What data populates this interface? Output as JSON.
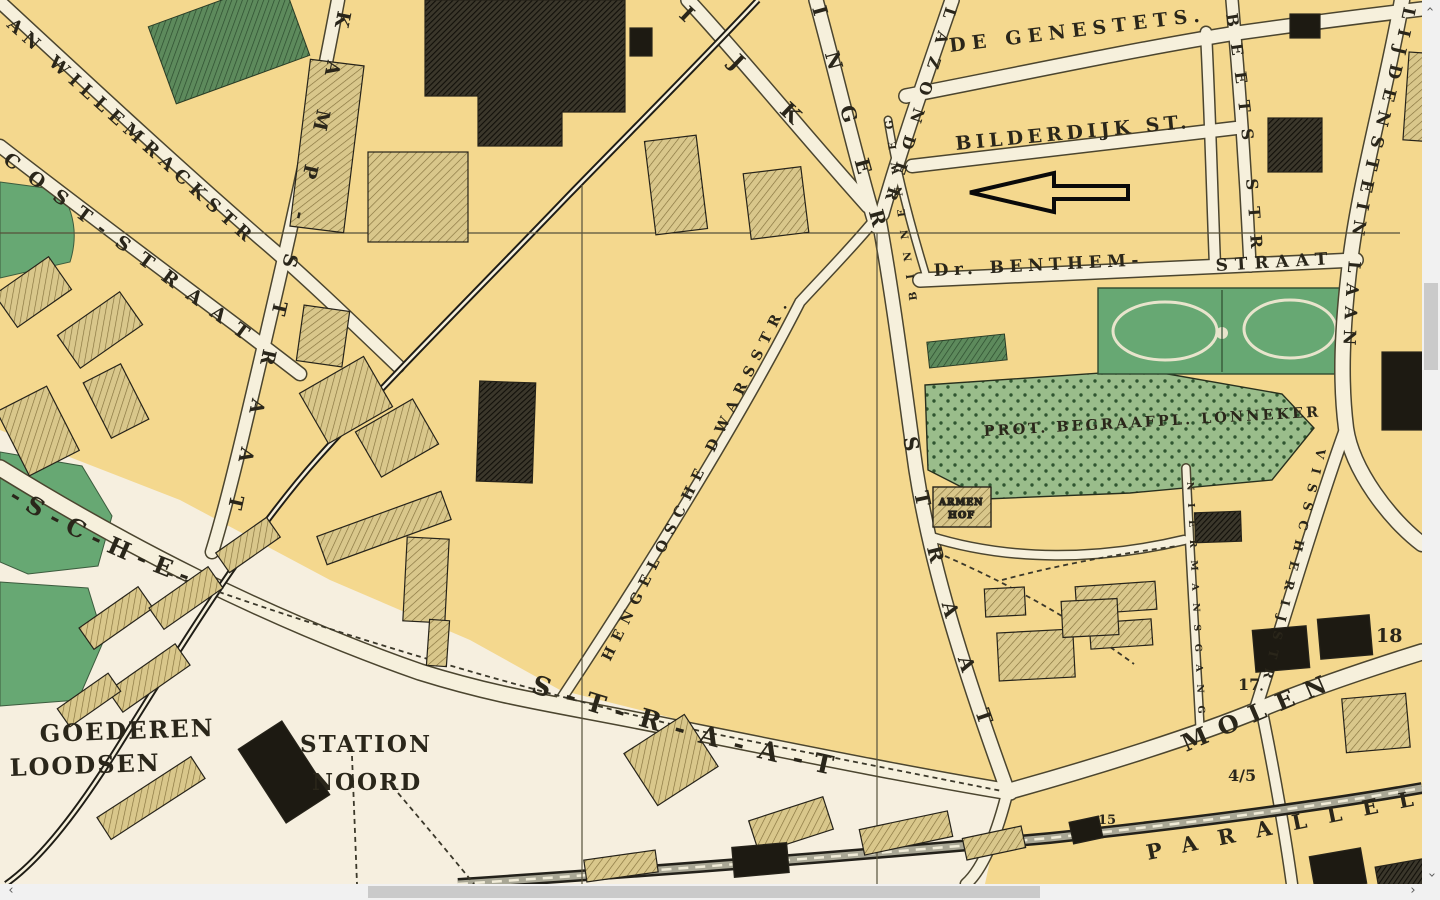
{
  "map": {
    "streets": {
      "willemrack": "AN WILLEMRACKSTR",
      "cost": "COST-STRAAT",
      "kamp": "KAMP-STRAAT",
      "ijk": "IJK",
      "inger": "INGER",
      "lazonder": "LAZONDER",
      "lasonder_straat": "STRAAT",
      "binnenweg": "BINNENWEG",
      "genestet": "DE GENESTETS.",
      "bilderdijk": "BILDERDIJK ST.",
      "beets": "BEETS STR",
      "benthem": "Dr. BENTHEM-",
      "benthem_straat": "STRAAT",
      "blijdenstein": "LIJDENSTEIN LAAN",
      "visscherij": "VISSCHERIJSTR.",
      "niermansgang": "NIERMANSGANG",
      "dwarsstraat": "HENGELOSCHE DWARSSTR.",
      "sche": "-S-C-H-E-",
      "straat_big": "S-T-R-A-A-T",
      "molen": "MOLEN",
      "parallel": "PARALLEL"
    },
    "places": {
      "prot_begraafplaats": "PROT. BEGRAAFPL. LONNEKER",
      "goederen": "GOEDEREN",
      "loodsen": "LOODSEN",
      "station": "STATION",
      "noord": "NOORD",
      "hof_line1": "ARMEN",
      "hof_line2": "HOF"
    },
    "numbers": {
      "n18": "18",
      "n17": "17",
      "n45": "4/5",
      "n15": "15"
    },
    "colors": {
      "block_yellow": "#f4d88e",
      "pale_ground": "#f6efdf",
      "road": "#f6f0dc",
      "park_green": "#67a873",
      "cemetery_green": "#9abd8b",
      "building_tan": "#d9c78b",
      "building_dark": "#1d1a12",
      "ink": "#2a261a",
      "scrollbar_track": "#f1f1f1",
      "scrollbar_thumb": "#cacaca"
    }
  },
  "scrollbars": {
    "up_arrow": "›",
    "down_arrow": "›",
    "left_arrow": "‹",
    "right_arrow": "›"
  }
}
